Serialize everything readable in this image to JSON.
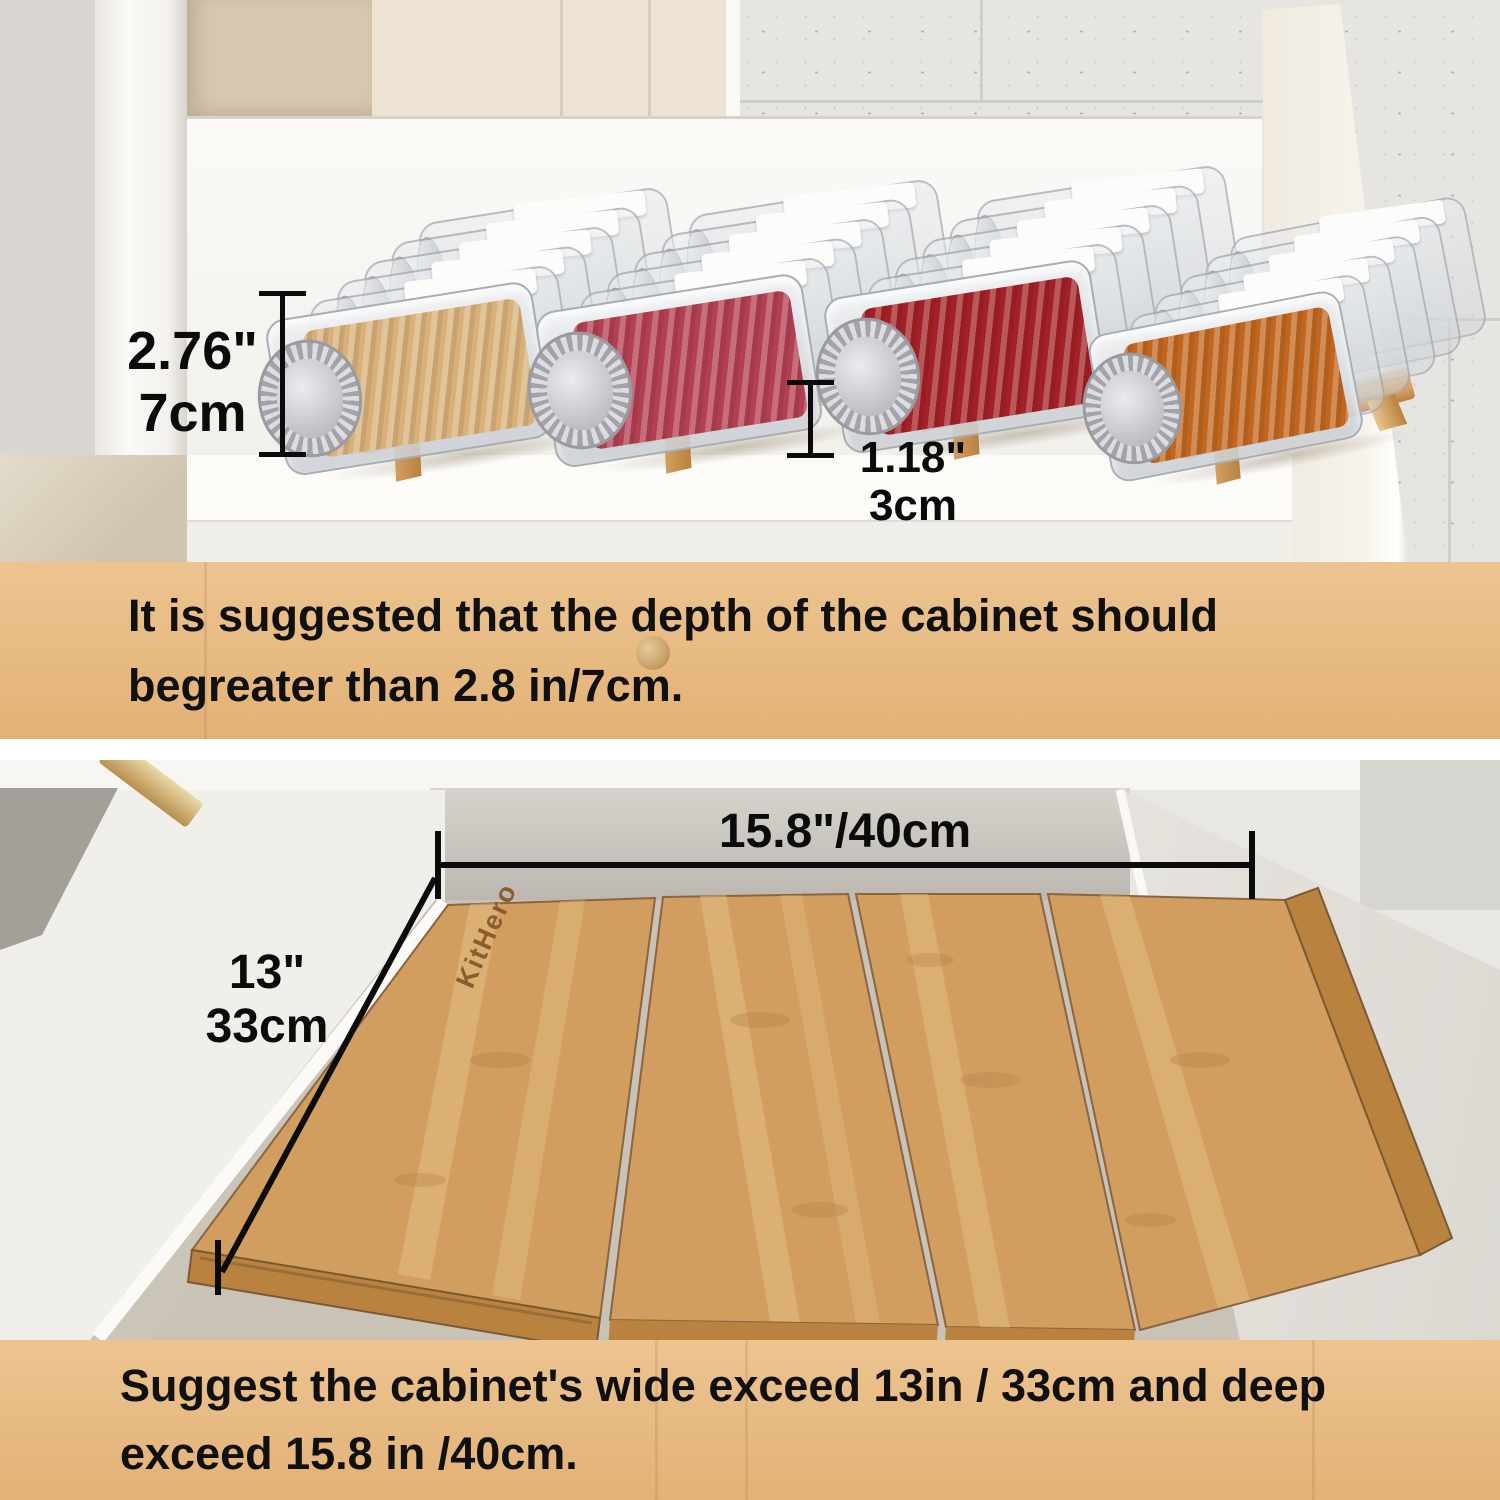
{
  "page": {
    "type": "product infographic",
    "product": "bamboo drawer spice rack organizer"
  },
  "brand": "KitHero",
  "banners": {
    "top": {
      "line1": "It is suggested that the depth of the cabinet should",
      "line2": "begreater than 2.8 in/7cm."
    },
    "bottom": {
      "line1": "Suggest the cabinet's wide exceed 13in / 33cm and deep",
      "line2": "exceed 15.8 in /40cm."
    }
  },
  "dimensions": {
    "jar_clearance": {
      "inches": "2.76\"",
      "metric": "7cm"
    },
    "step_height": {
      "inches": "1.18\"",
      "metric": "3cm"
    },
    "organizer_depth": "15.8\"/40cm",
    "organizer_width": {
      "inches": "13\"",
      "metric": "33cm"
    }
  },
  "colors": {
    "banner": "#eaba7e",
    "annotation": "#0b0b0b",
    "bamboo": "#d29e60",
    "bamboo_light": "#e9c68e",
    "bamboo_dark": "#b9823f",
    "lid_silver": "#c6c7cc",
    "jar_ginger": "#d9b07a",
    "jar_rose": "#b23f52",
    "jar_chili": "#a32126",
    "jar_dried": "#c2661f",
    "tile_wall": "#e6e5e1",
    "cream_cabinet": "#ece3d3",
    "white_panel": "#f8f6f3"
  }
}
